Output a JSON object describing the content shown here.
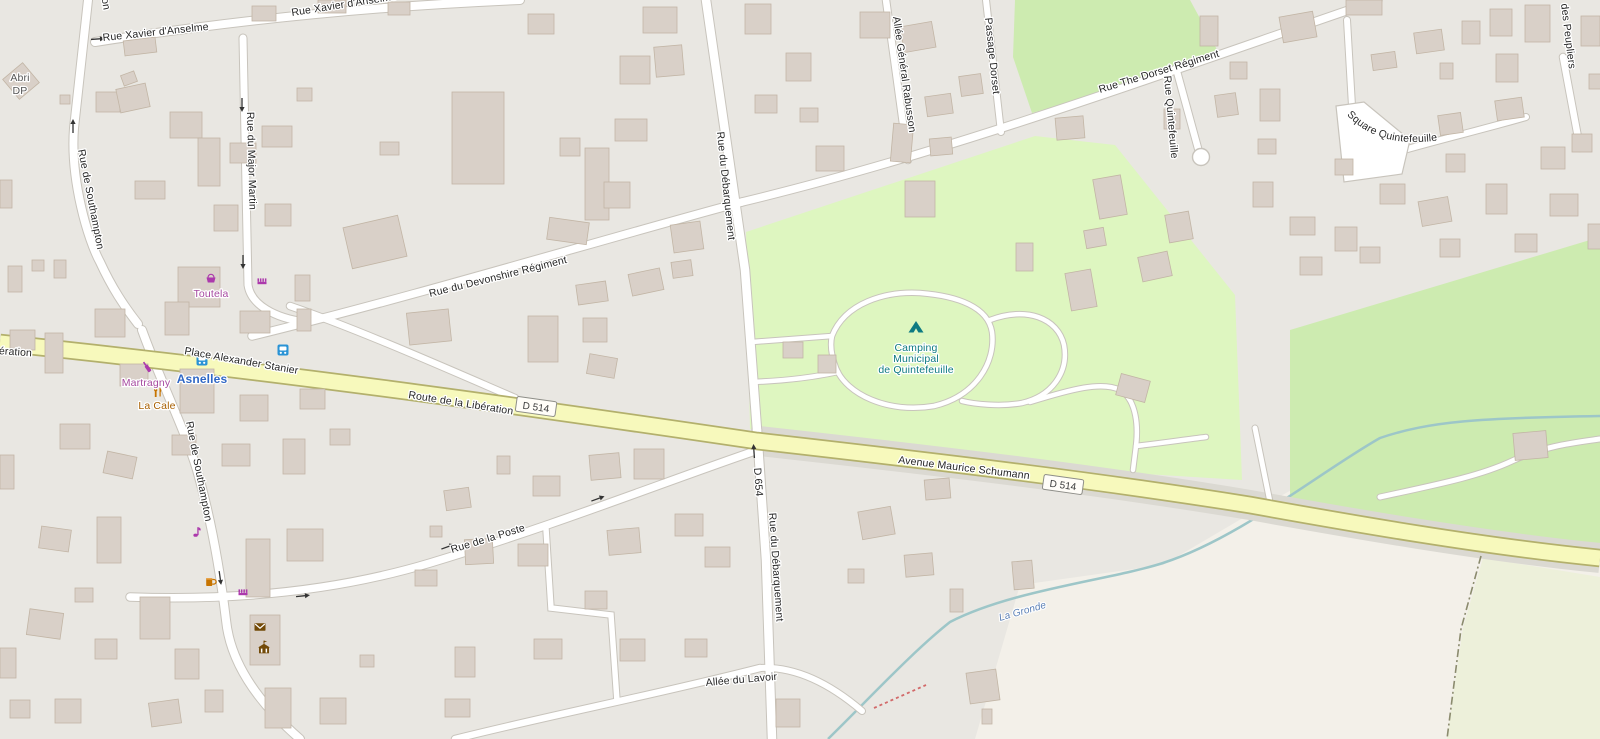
{
  "app": {
    "name": "map-tile-view",
    "area": "Asnelles"
  },
  "labels": {
    "rue_xavier_anselme": "Rue Xavier d'Anselme",
    "rue_de_southampton": "Rue de Southampton",
    "rue_du_major_martin": "Rue du Major Martin",
    "rue_du_debarquement": "Rue du Débarquement",
    "rue_du_devonshire_regiment": "Rue du Devonshire Régiment",
    "rue_the_dorset_regiment": "Rue The Dorset Régiment",
    "allee_general_rabusson": "Allée Général Rabusson",
    "passage_dorset": "Passage Dorset",
    "rue_quintefeuille": "Rue Quintefeuille",
    "square_quintefeuille": "Square Quintefeuille",
    "des_peupliers": "des Peupliers",
    "place_alexander_stanier": "Place Alexander Stanier",
    "route_de_la_liberation": "Route de la Libération",
    "avenue_maurice_schumann": "Avenue Maurice Schumann",
    "rue_de_la_poste": "Rue de la Poste",
    "allee_du_lavoir": "Allée du Lavoir"
  },
  "road_refs": {
    "d514": "D 514",
    "d654": "D 654"
  },
  "place_labels": {
    "abri_line1": "Abri",
    "abri_line2": "DP"
  },
  "water": {
    "la_gronde": "La Gronde"
  },
  "pois": {
    "toutela": "Toutela",
    "martragny": "Martragny",
    "la_cale": "La Cale",
    "asnelles": "Asnelles",
    "camping_line1": "Camping",
    "camping_line2": "Municipal",
    "camping_line3": "de Quintefeuille"
  },
  "icons": [
    {
      "name": "bus-stop-icon",
      "color": "#2a93d5"
    },
    {
      "name": "supermarket-basket-icon",
      "color": "#ac39ac"
    },
    {
      "name": "hairdresser-comb-icon",
      "color": "#ac39ac"
    },
    {
      "name": "wine-shop-bottle-icon",
      "color": "#ac39ac"
    },
    {
      "name": "music-shop-icon",
      "color": "#ac39ac"
    },
    {
      "name": "restaurant-fork-knife-icon",
      "color": "#c77400"
    },
    {
      "name": "pub-mug-icon",
      "color": "#c77400"
    },
    {
      "name": "post-office-envelope-icon",
      "color": "#734a08"
    },
    {
      "name": "townhall-icon",
      "color": "#734a08"
    },
    {
      "name": "camping-tent-icon",
      "color": "#0e7a82"
    }
  ],
  "colors": {
    "residential": "#e9e7e2",
    "farmland": "#f3f0e9",
    "grass": "#cdebb0",
    "camp_site": "#def6c0",
    "road_secondary": "#f7f9bc",
    "road_white": "#ffffff",
    "building": "#d9d0c8",
    "stream": "#9dc6c8"
  }
}
